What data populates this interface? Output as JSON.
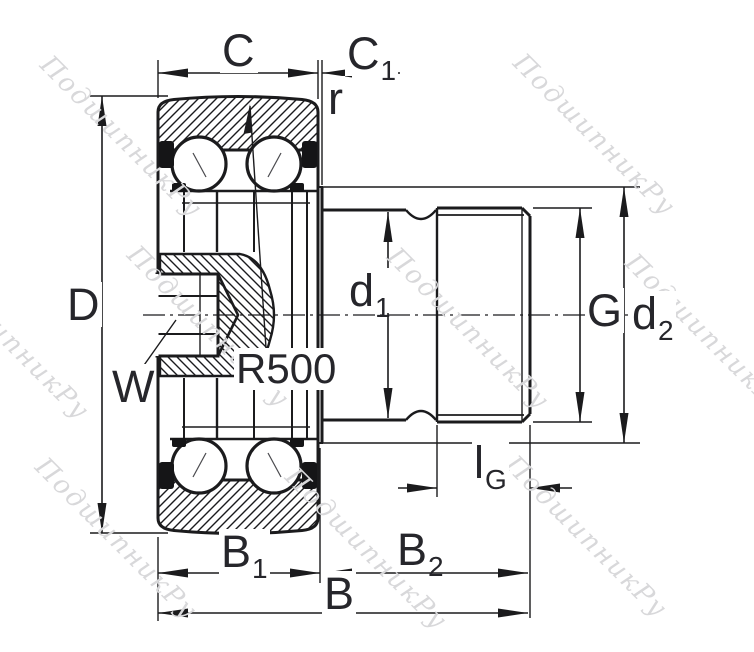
{
  "drawing_title": "track roller bearing cross-section",
  "labels": {
    "C": {
      "main": "C",
      "sub": ""
    },
    "C1": {
      "main": "C",
      "sub": "1"
    },
    "r": {
      "main": "r",
      "sub": ""
    },
    "D": {
      "main": "D",
      "sub": ""
    },
    "W": {
      "main": "W",
      "sub": ""
    },
    "R500": {
      "main": "R500",
      "sub": ""
    },
    "d1": {
      "main": "d",
      "sub": "1"
    },
    "G": {
      "main": "G",
      "sub": ""
    },
    "d2": {
      "main": "d",
      "sub": "2"
    },
    "lG": {
      "main": "l",
      "sub": "G"
    },
    "B1": {
      "main": "B",
      "sub": "1"
    },
    "B2": {
      "main": "B",
      "sub": "2"
    },
    "B": {
      "main": "B",
      "sub": ""
    }
  },
  "watermark": {
    "text": "ПодшипникРу",
    "color": "#d8d8da",
    "positions": [
      {
        "x": 55,
        "y": 50
      },
      {
        "x": 528,
        "y": 48
      },
      {
        "x": -58,
        "y": 252
      },
      {
        "x": 142,
        "y": 240
      },
      {
        "x": 402,
        "y": 242
      },
      {
        "x": 640,
        "y": 248
      },
      {
        "x": 50,
        "y": 452
      },
      {
        "x": 300,
        "y": 462
      },
      {
        "x": 520,
        "y": 450
      }
    ]
  },
  "colors": {
    "line": "#1b1b1d",
    "label": "#26262b",
    "background": "#ffffff"
  }
}
